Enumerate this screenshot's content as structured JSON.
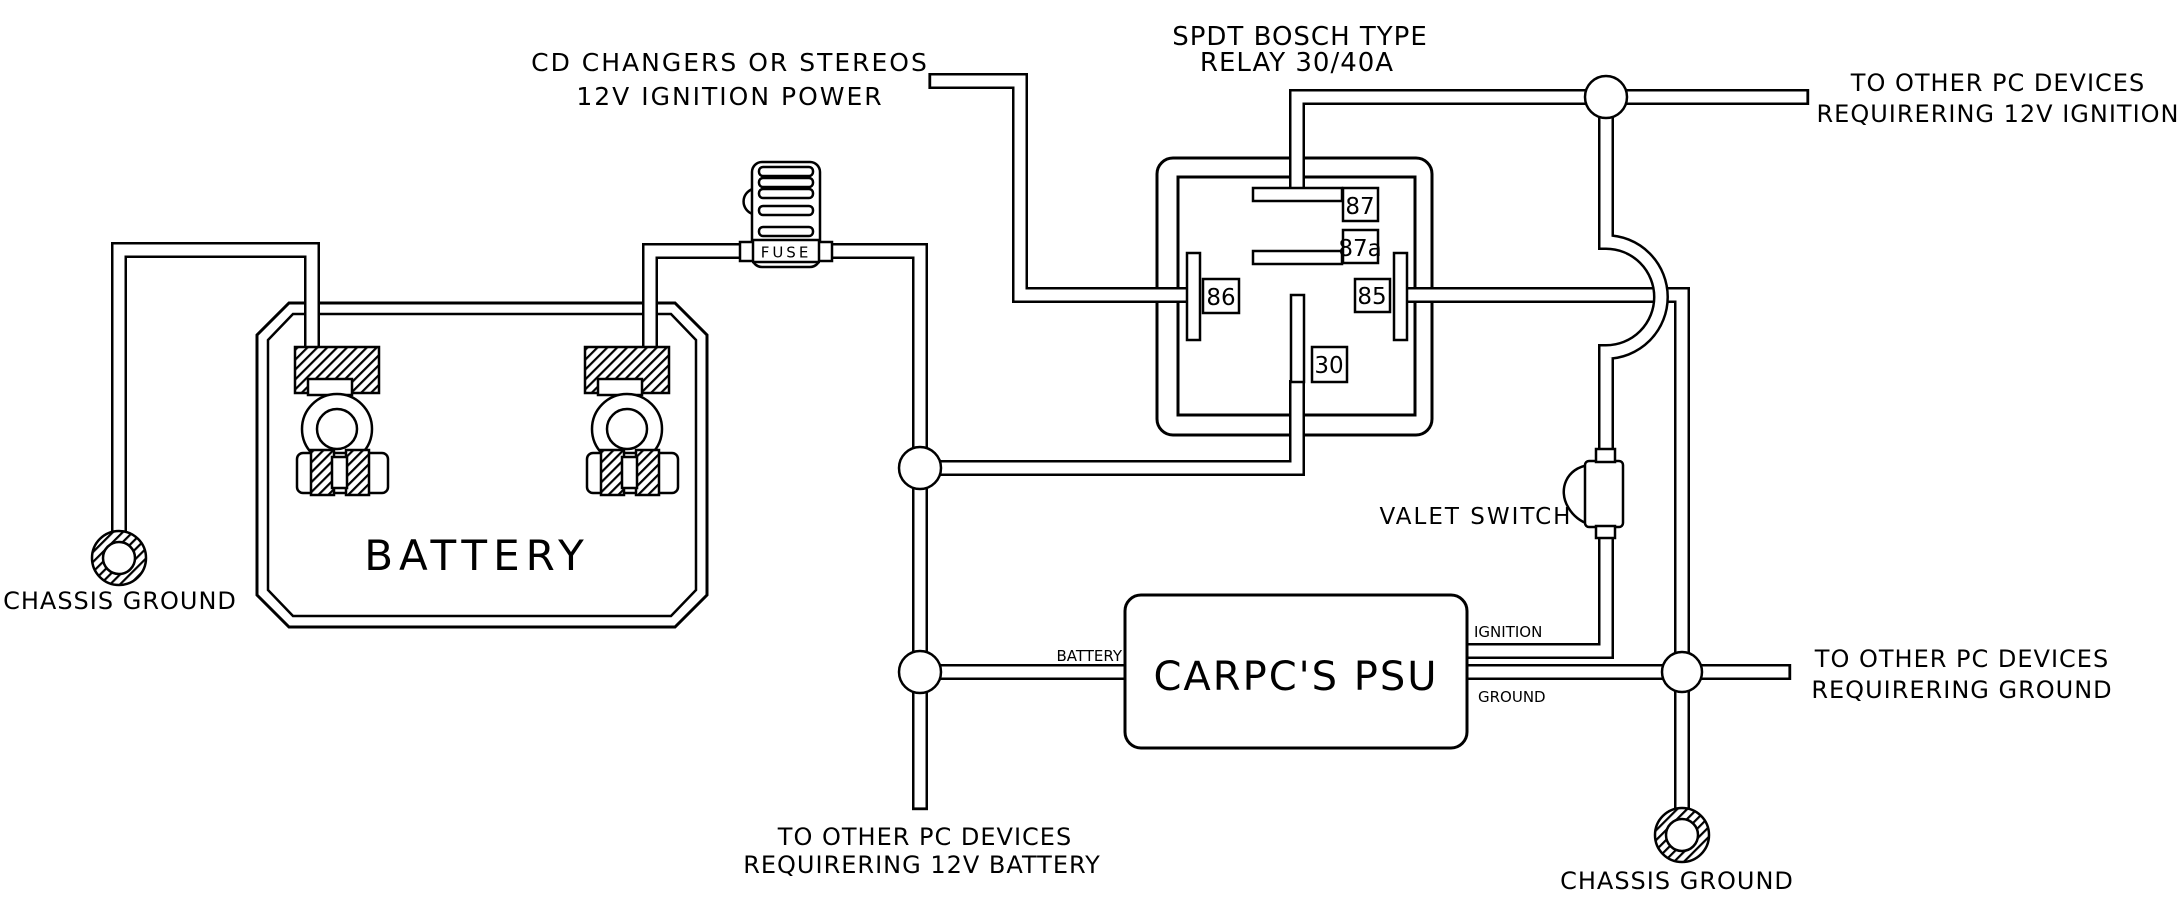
{
  "diagram": {
    "relay_title": {
      "line1": "SPDT BOSCH TYPE",
      "line2": "RELAY 30/40A"
    },
    "labels": {
      "cd_power": {
        "line1": "CD CHANGERS OR STEREOS",
        "line2": "12V IGNITION POWER"
      },
      "ignition_devices": {
        "line1": "TO OTHER PC DEVICES",
        "line2": "REQUIRERING 12V IGNITION"
      },
      "ground_devices": {
        "line1": "TO OTHER PC DEVICES",
        "line2": "REQUIRERING GROUND"
      },
      "battery_devices": {
        "line1": "TO OTHER PC DEVICES",
        "line2": "REQUIRERING 12V BATTERY"
      },
      "chassis_ground_left": "CHASSIS GROUND",
      "chassis_ground_right": "CHASSIS GROUND",
      "valet_switch": "VALET SWITCH"
    },
    "components": {
      "battery": {
        "label": "BATTERY"
      },
      "fuse": {
        "label": "FUSE"
      },
      "psu": {
        "label": "CARPC'S PSU",
        "terminals": {
          "battery": "BATTERY",
          "ignition": "IGNITION",
          "ground": "GROUND"
        }
      },
      "relay": {
        "pins": [
          {
            "id": "87"
          },
          {
            "id": "87a"
          },
          {
            "id": "86"
          },
          {
            "id": "85"
          },
          {
            "id": "30"
          }
        ]
      }
    },
    "colors": {
      "line": "#000000",
      "background": "#ffffff"
    }
  }
}
